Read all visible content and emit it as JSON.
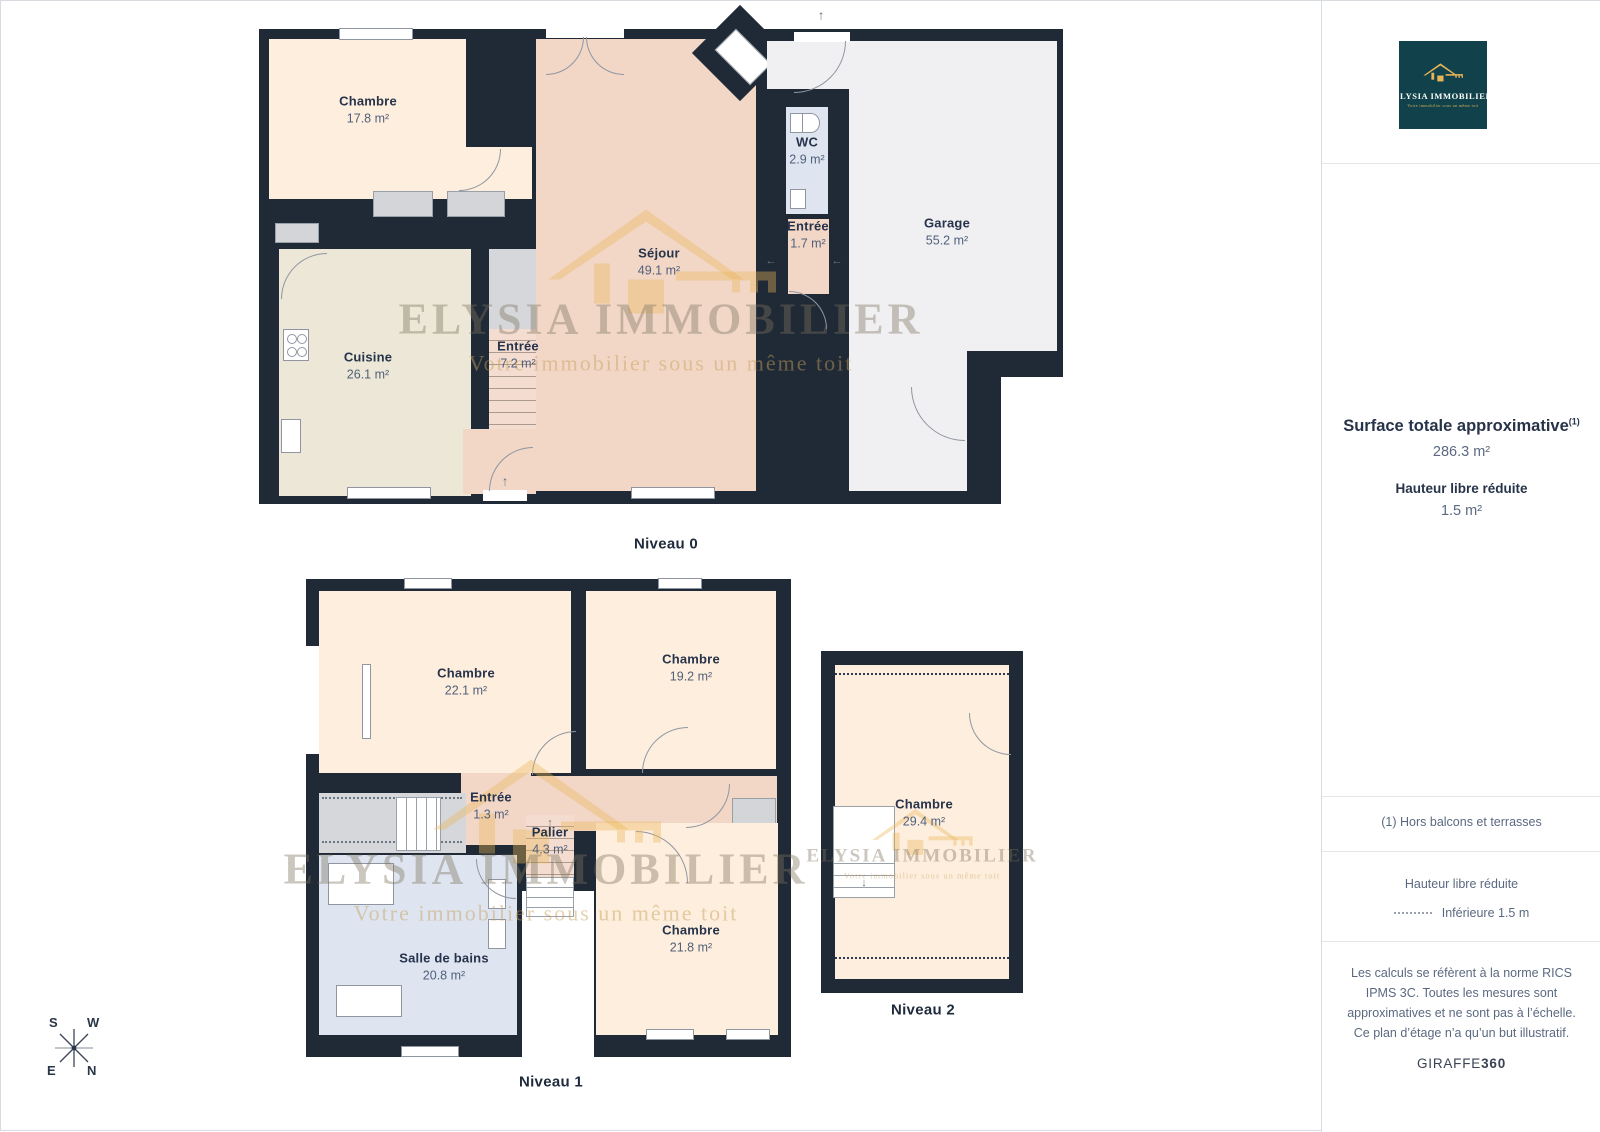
{
  "branding": {
    "logo_title": "ELYSIA IMMOBILIER",
    "logo_tagline": "Votre immobilier sous un même toit"
  },
  "watermark": {
    "line1": "ELYSIA IMMOBILIER",
    "line2": "Votre immobilier sous un même toit"
  },
  "sidebar": {
    "surface_title": "Surface totale approximative",
    "surface_superscript": "(1)",
    "surface_value": "286.3 m²",
    "reduced_height_title": "Hauteur libre réduite",
    "reduced_height_value": "1.5 m²",
    "footnote": "(1) Hors balcons et terrasses",
    "legend_title": "Hauteur libre réduite",
    "legend_item": "Inférieure 1.5 m",
    "disclaimer": "Les calculs se réfèrent à la norme RICS IPMS 3C. Toutes les mesures sont approximatives et ne sont pas à l’échelle. Ce plan d’étage n’a qu’un but illustratif.",
    "brand_name": "GIRAFFE",
    "brand_suffix": "360"
  },
  "floors": [
    {
      "label": "Niveau 0",
      "rooms": [
        {
          "name": "Chambre",
          "area": "17.8 m²"
        },
        {
          "name": "Cuisine",
          "area": "26.1 m²"
        },
        {
          "name": "Entrée",
          "area": "7.2 m²"
        },
        {
          "name": "Séjour",
          "area": "49.1 m²"
        },
        {
          "name": "WC",
          "area": "2.9 m²"
        },
        {
          "name": "Entrée",
          "area": "1.7 m²"
        },
        {
          "name": "Garage",
          "area": "55.2 m²"
        }
      ]
    },
    {
      "label": "Niveau 1",
      "rooms": [
        {
          "name": "Chambre",
          "area": "22.1 m²"
        },
        {
          "name": "Chambre",
          "area": "19.2 m²"
        },
        {
          "name": "Entrée",
          "area": "1.3 m²"
        },
        {
          "name": "Palier",
          "area": "4.3 m²"
        },
        {
          "name": "Salle de bains",
          "area": "20.8 m²"
        },
        {
          "name": "Chambre",
          "area": "21.8 m²"
        }
      ]
    },
    {
      "label": "Niveau 2",
      "rooms": [
        {
          "name": "Chambre",
          "area": "29.4 m²"
        }
      ]
    }
  ],
  "compass": {
    "s": "S",
    "w": "W",
    "e": "E",
    "n": "N"
  }
}
